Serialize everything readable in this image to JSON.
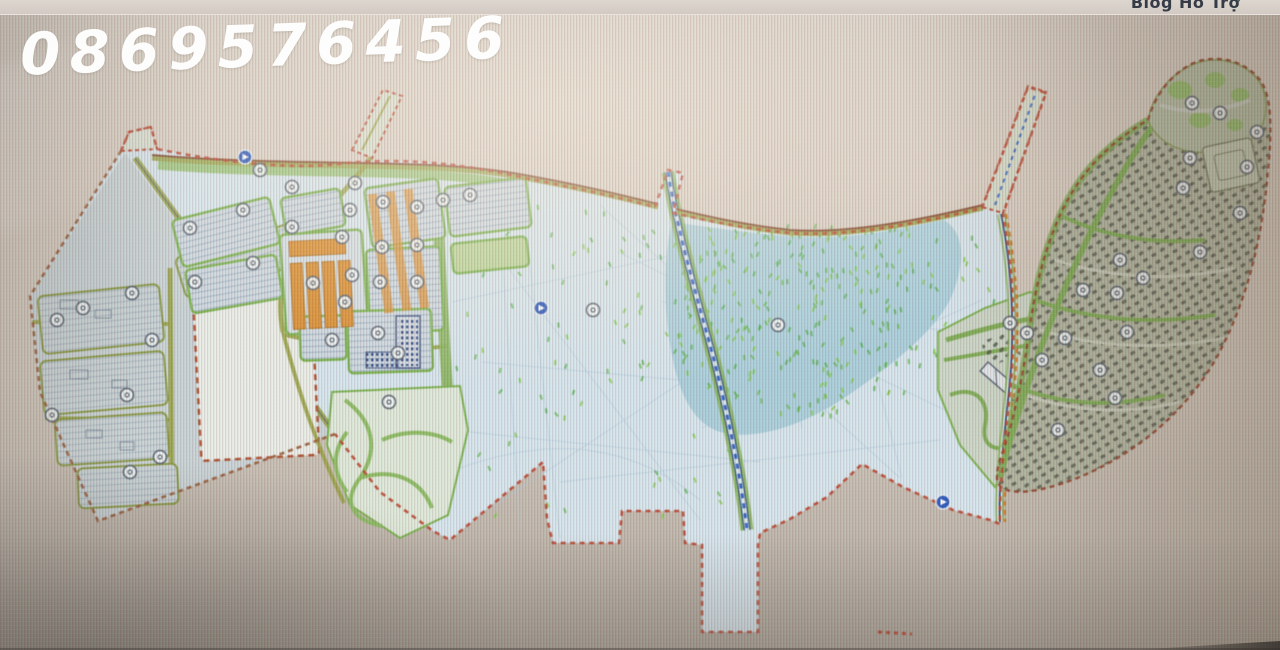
{
  "screen": {
    "top_bar_text": "Blog Hỗ Trợ",
    "watermark": "0869576456"
  },
  "map": {
    "type": "urban-master-plan",
    "palette": {
      "boundary_red": "#c2422c",
      "boundary_brown": "#9c5a35",
      "land": "#d6e5ef",
      "left_lobe": "#c9d3d8",
      "lake": "#a6cfdd",
      "block_border_green": "#79b34a",
      "verge_green": "#86b457",
      "road_olive": "#98a23f",
      "industrial_orange": "#e08e2c",
      "canal_blue": "#2f62cc",
      "road_dark_blue": "#2b4a7a",
      "dense_buildings": "#4f5449",
      "dense_zone": "#b4b7a3",
      "marker_blue": "#2757c4"
    },
    "markers": [
      [
        260,
        170,
        0
      ],
      [
        292,
        187,
        0
      ],
      [
        243,
        210,
        0
      ],
      [
        190,
        228,
        0
      ],
      [
        292,
        227,
        0
      ],
      [
        253,
        263,
        0
      ],
      [
        132,
        293,
        0
      ],
      [
        83,
        308,
        0
      ],
      [
        57,
        320,
        0
      ],
      [
        152,
        340,
        0
      ],
      [
        127,
        395,
        0
      ],
      [
        52,
        415,
        0
      ],
      [
        160,
        457,
        0
      ],
      [
        130,
        472,
        0
      ],
      [
        195,
        282,
        0
      ],
      [
        355,
        183,
        0
      ],
      [
        383,
        202,
        0
      ],
      [
        417,
        207,
        0
      ],
      [
        443,
        200,
        0
      ],
      [
        470,
        195,
        0
      ],
      [
        350,
        210,
        0
      ],
      [
        342,
        237,
        0
      ],
      [
        382,
        247,
        0
      ],
      [
        417,
        245,
        0
      ],
      [
        352,
        275,
        0
      ],
      [
        380,
        282,
        0
      ],
      [
        417,
        282,
        0
      ],
      [
        313,
        283,
        0
      ],
      [
        345,
        302,
        0
      ],
      [
        332,
        340,
        0
      ],
      [
        378,
        333,
        0
      ],
      [
        398,
        353,
        0
      ],
      [
        389,
        402,
        0
      ],
      [
        593,
        310,
        0
      ],
      [
        778,
        325,
        0
      ],
      [
        1192,
        103,
        0
      ],
      [
        1220,
        113,
        0
      ],
      [
        1257,
        132,
        0
      ],
      [
        1190,
        158,
        0
      ],
      [
        1247,
        167,
        0
      ],
      [
        1183,
        188,
        0
      ],
      [
        1240,
        213,
        0
      ],
      [
        1120,
        260,
        0
      ],
      [
        1143,
        278,
        0
      ],
      [
        1200,
        252,
        0
      ],
      [
        1083,
        290,
        0
      ],
      [
        1117,
        293,
        0
      ],
      [
        1127,
        332,
        0
      ],
      [
        1065,
        338,
        0
      ],
      [
        1100,
        370,
        0
      ],
      [
        1115,
        398,
        0
      ],
      [
        1010,
        323,
        0
      ],
      [
        1027,
        333,
        0
      ],
      [
        1042,
        360,
        0
      ],
      [
        1058,
        430,
        0
      ],
      [
        245,
        157,
        1
      ],
      [
        541,
        308,
        1
      ],
      [
        943,
        502,
        1
      ]
    ],
    "speckle_regions": [
      {
        "kind": "ellipse",
        "cx": 808,
        "cy": 318,
        "rx": 148,
        "ry": 98,
        "n": 230
      },
      {
        "kind": "rect",
        "x": 668,
        "y": 222,
        "w": 270,
        "h": 50,
        "n": 60
      },
      {
        "kind": "rect",
        "x": 606,
        "y": 230,
        "w": 60,
        "h": 150,
        "n": 22
      },
      {
        "kind": "rect",
        "x": 455,
        "y": 195,
        "w": 150,
        "h": 320,
        "n": 48
      },
      {
        "kind": "rect",
        "x": 650,
        "y": 430,
        "w": 110,
        "h": 85,
        "n": 10
      },
      {
        "kind": "rect",
        "x": 955,
        "y": 235,
        "w": 45,
        "h": 70,
        "n": 8
      }
    ],
    "speckle_colors": [
      "#4fb048",
      "#7cc93f",
      "#62b84a"
    ]
  }
}
